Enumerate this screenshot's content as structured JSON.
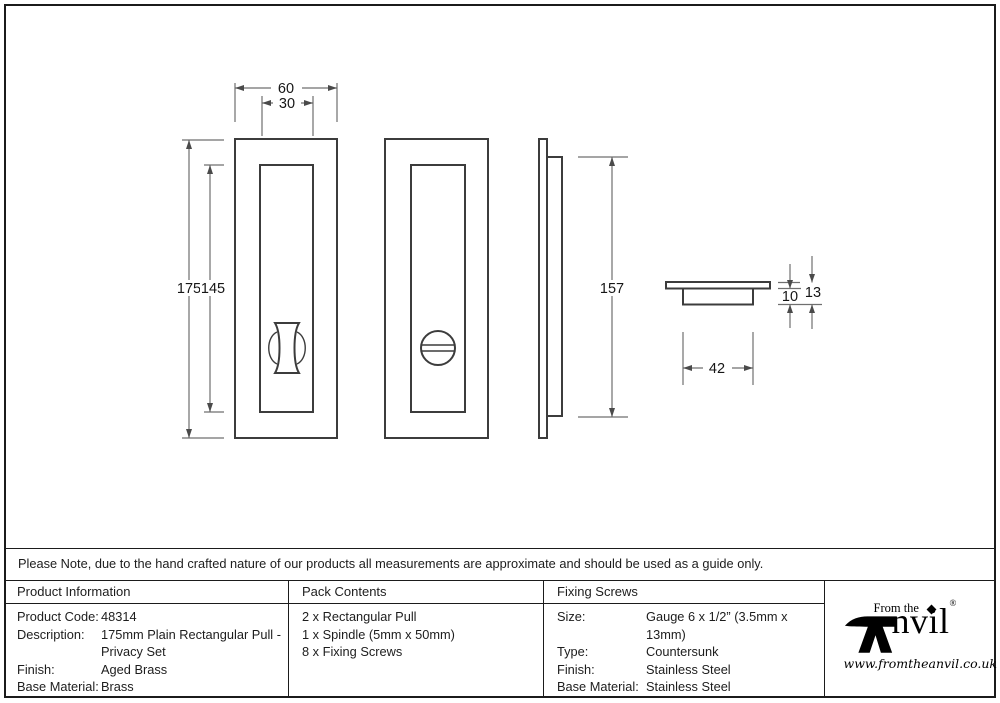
{
  "note": "Please Note, due to the hand crafted nature of our products all measurements are approximate and should be used as a guide only.",
  "drawing": {
    "dims": {
      "outer_width": "60",
      "recess_width": "30",
      "outer_height": "175",
      "recess_height": "145",
      "plate_height": "157",
      "back_width": "42",
      "back_depth": "10",
      "total_depth": "13"
    }
  },
  "table": {
    "product_information": {
      "header": "Product Information",
      "rows": [
        {
          "label": "Product Code:",
          "value": "48314"
        },
        {
          "label": "Description:",
          "value": "175mm Plain Rectangular Pull -"
        },
        {
          "label": "",
          "value": "Privacy Set"
        },
        {
          "label": "Finish:",
          "value": "Aged Brass"
        },
        {
          "label": "Base Material:",
          "value": "Brass"
        }
      ]
    },
    "pack_contents": {
      "header": "Pack Contents",
      "items": [
        "2 x Rectangular Pull",
        "1 x Spindle (5mm x 50mm)",
        "8 x Fixing Screws"
      ]
    },
    "fixing_screws": {
      "header": "Fixing Screws",
      "rows": [
        {
          "label": "Size:",
          "value": "Gauge 6 x 1/2” (3.5mm x 13mm)"
        },
        {
          "label": "Type:",
          "value": "Countersunk"
        },
        {
          "label": "Finish:",
          "value": "Stainless Steel"
        },
        {
          "label": "Base Material:",
          "value": "Stainless Steel"
        }
      ]
    }
  },
  "logo": {
    "tagline": "From the",
    "brand": "nvil",
    "registered": "®",
    "url": "www.fromtheanvil.co.uk"
  }
}
